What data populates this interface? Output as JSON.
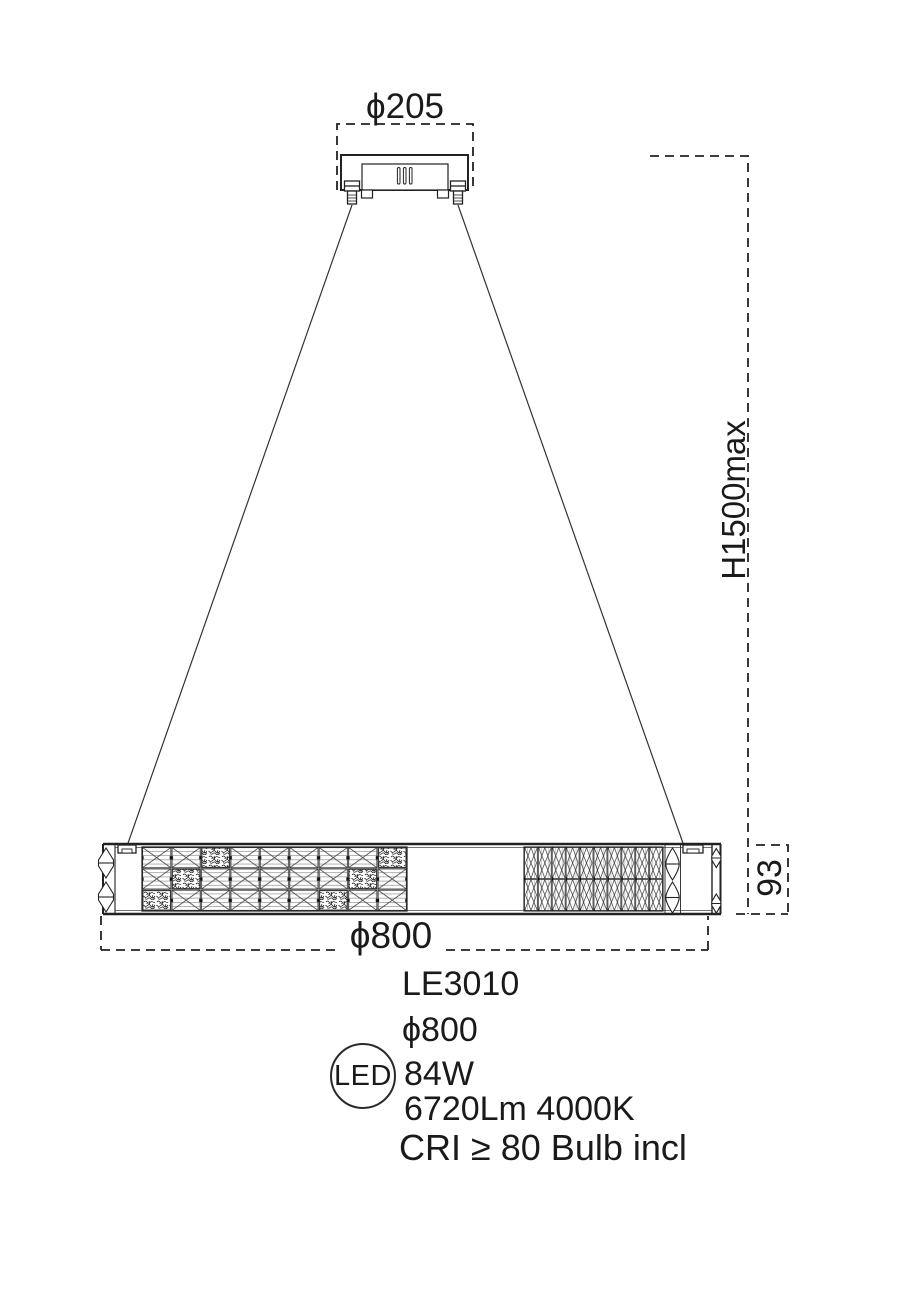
{
  "drawing": {
    "canopy_diameter_label": "ϕ205",
    "height_label": "H1500max",
    "fixture_height_label": "93",
    "fixture_diameter_label": "ϕ800"
  },
  "specs": {
    "model": "LE3010",
    "diameter": "ϕ800",
    "led_badge": "LED",
    "wattage": "84W",
    "lumens_cct": "6720Lm 4000K",
    "cri_note": "CRI ≥ 80 Bulb incl"
  },
  "colors": {
    "line": "#222222",
    "text": "#1a1a1a",
    "background": "#ffffff"
  }
}
